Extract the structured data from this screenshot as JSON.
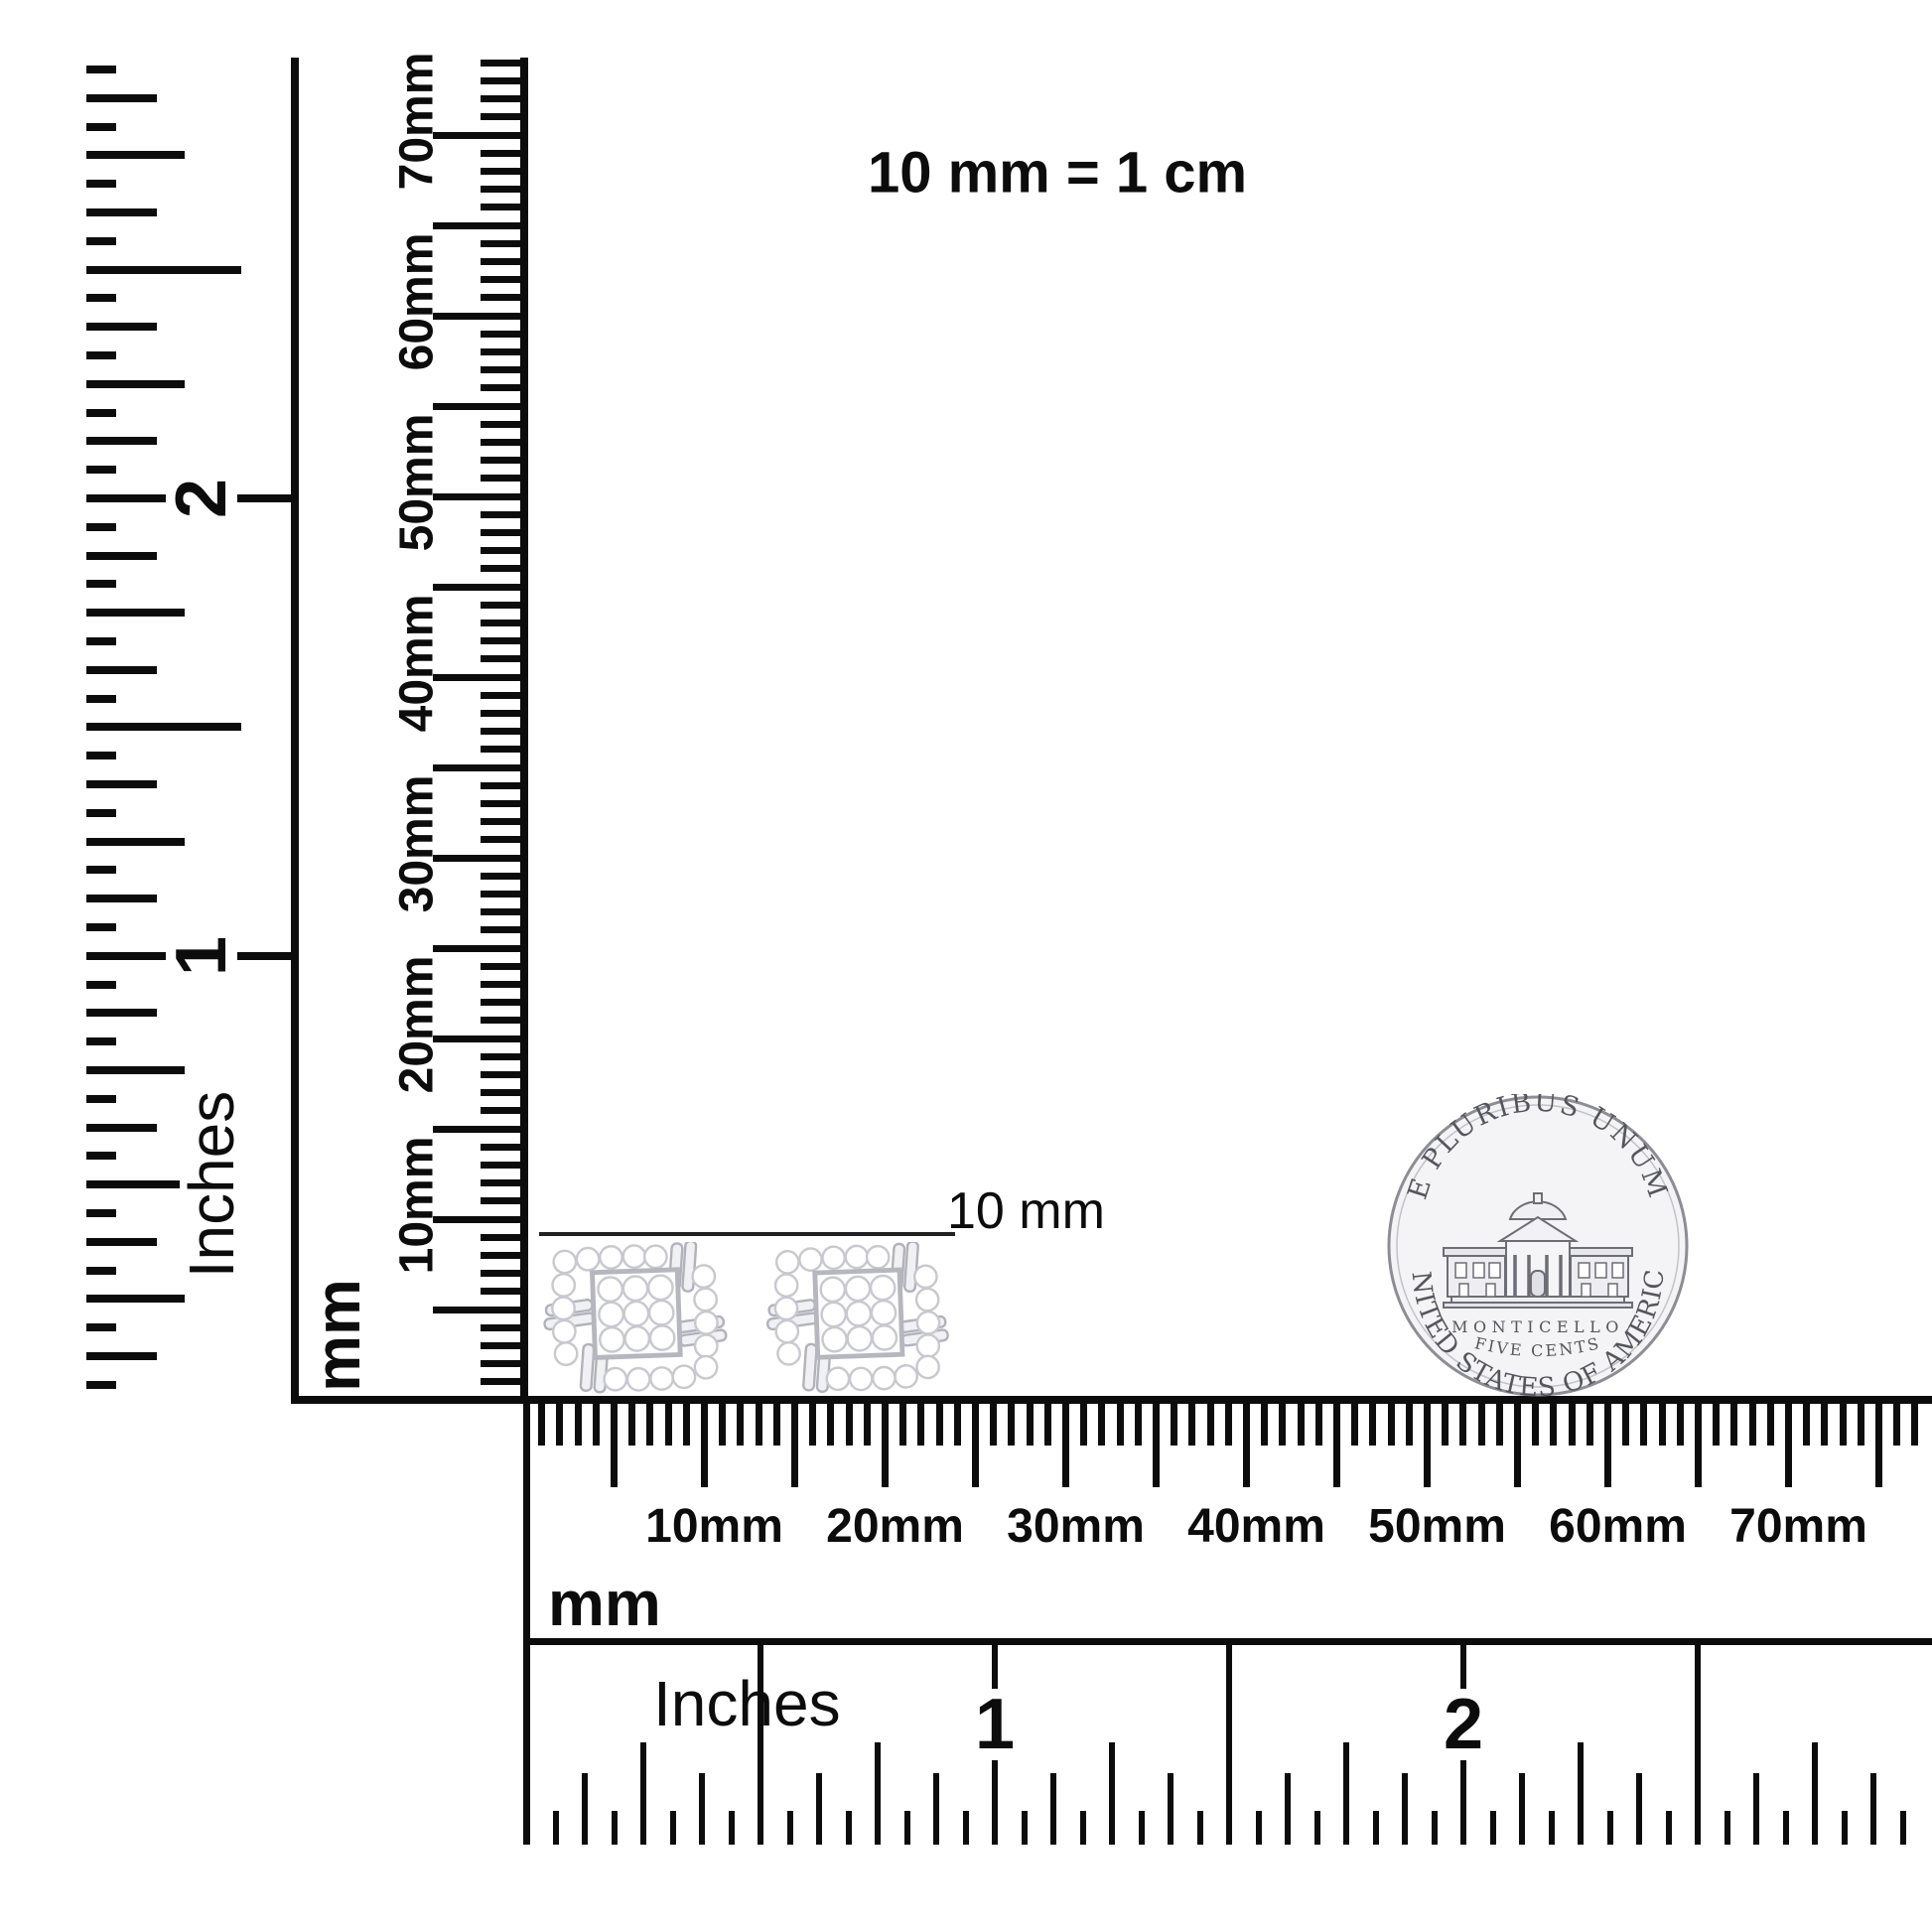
{
  "title_note": "10 mm = 1 cm",
  "measure_label": "10 mm",
  "rulers": {
    "left_inch": {
      "unit": "Inches",
      "numerals": [
        "1",
        "2"
      ]
    },
    "left_mm": {
      "unit": "mm",
      "labels": [
        "10mm",
        "20mm",
        "30mm",
        "40mm",
        "50mm",
        "60mm",
        "70mm"
      ]
    },
    "bottom_mm": {
      "unit": "mm",
      "labels": [
        "10mm",
        "20mm",
        "30mm",
        "40mm",
        "50mm",
        "60mm",
        "70mm"
      ]
    },
    "bottom_inch": {
      "unit": "Inches",
      "numerals": [
        "1",
        "2"
      ]
    }
  },
  "coin": {
    "top_text": "E PLURIBUS UNUM",
    "building_label": "MONTICELLO",
    "denomination": "FIVE CENTS",
    "bottom_text": "UNITED STATES OF AMERICA"
  },
  "colors": {
    "ink": "#0c0c0c",
    "line": "#222222",
    "coin_face": "#f4f4f6",
    "coin_edge": "#8d8d95",
    "coin_detail": "#6d6d76",
    "coin_text": "#55555e",
    "metal": "#f1f1f5",
    "metal_edge": "#b2b2bb",
    "stone": "#ffffff",
    "stone_edge": "#c8c8d0"
  }
}
